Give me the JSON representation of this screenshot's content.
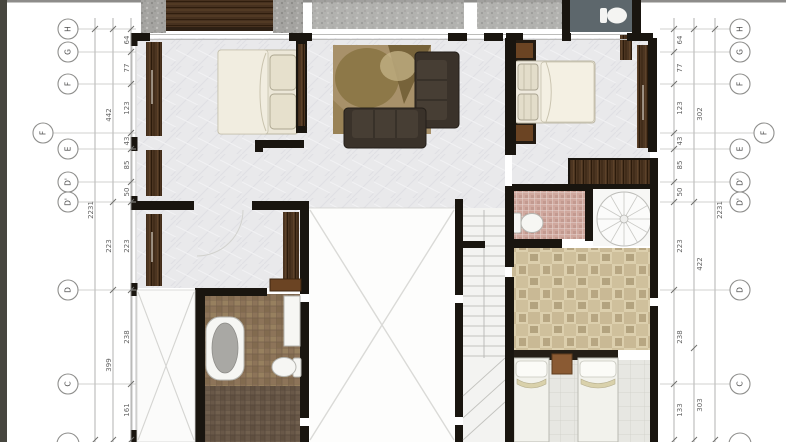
{
  "drawing": {
    "type": "architectural-floor-plan",
    "view": "top-down furnished plan with dimension strings and grid bubbles on both sides"
  },
  "grid_bubbles": {
    "left": [
      {
        "label": "H"
      },
      {
        "label": "G"
      },
      {
        "label": "F"
      },
      {
        "label": "F"
      },
      {
        "label": "E"
      },
      {
        "label": "D'"
      },
      {
        "label": "D'"
      },
      {
        "label": "D"
      },
      {
        "label": "C"
      },
      {
        "label": ""
      }
    ],
    "right": [
      {
        "label": "H"
      },
      {
        "label": "G"
      },
      {
        "label": "F"
      },
      {
        "label": "F"
      },
      {
        "label": "E"
      },
      {
        "label": "D'"
      },
      {
        "label": "D'"
      },
      {
        "label": "D"
      },
      {
        "label": "C"
      },
      {
        "label": ""
      }
    ]
  },
  "dims": {
    "left_inner": [
      "64",
      "77",
      "123",
      "43",
      "85",
      "50",
      "223",
      "238",
      "161"
    ],
    "left_middle": [
      "442",
      "223",
      "399"
    ],
    "left_total": "2231",
    "right_inner": [
      "64",
      "77",
      "123",
      "43",
      "85",
      "50",
      "223",
      "238",
      "133"
    ],
    "right_middle": [
      "302",
      "422",
      "303"
    ],
    "right_total": "2231"
  },
  "colors": {
    "wall": "#19150f",
    "wood": "#4c3521",
    "marble_floor": "#eaeaec",
    "concrete_balcony": "#a5a4a1",
    "teal_bathroom": "#5d676c",
    "rug": "#a8916a",
    "sofa": "#3a322a",
    "bed_linen": "#ece7d8",
    "brown_tile": "#8d7459",
    "dark_tile": "#695848",
    "beige_tile": "#dccfad",
    "mosaic_tile": "#d0a89e",
    "dim_line": "#a0a09e",
    "dim_text": "#636363"
  },
  "icons": [
    "toilet-icon",
    "bathtub-icon",
    "double-bed-icon",
    "single-bed-icon",
    "sofa-icon",
    "rug-icon",
    "wardrobe-icon",
    "spiral-stair-icon",
    "staircase-icon",
    "void-cross-icon",
    "grid-bubble",
    "dimension-tick"
  ]
}
